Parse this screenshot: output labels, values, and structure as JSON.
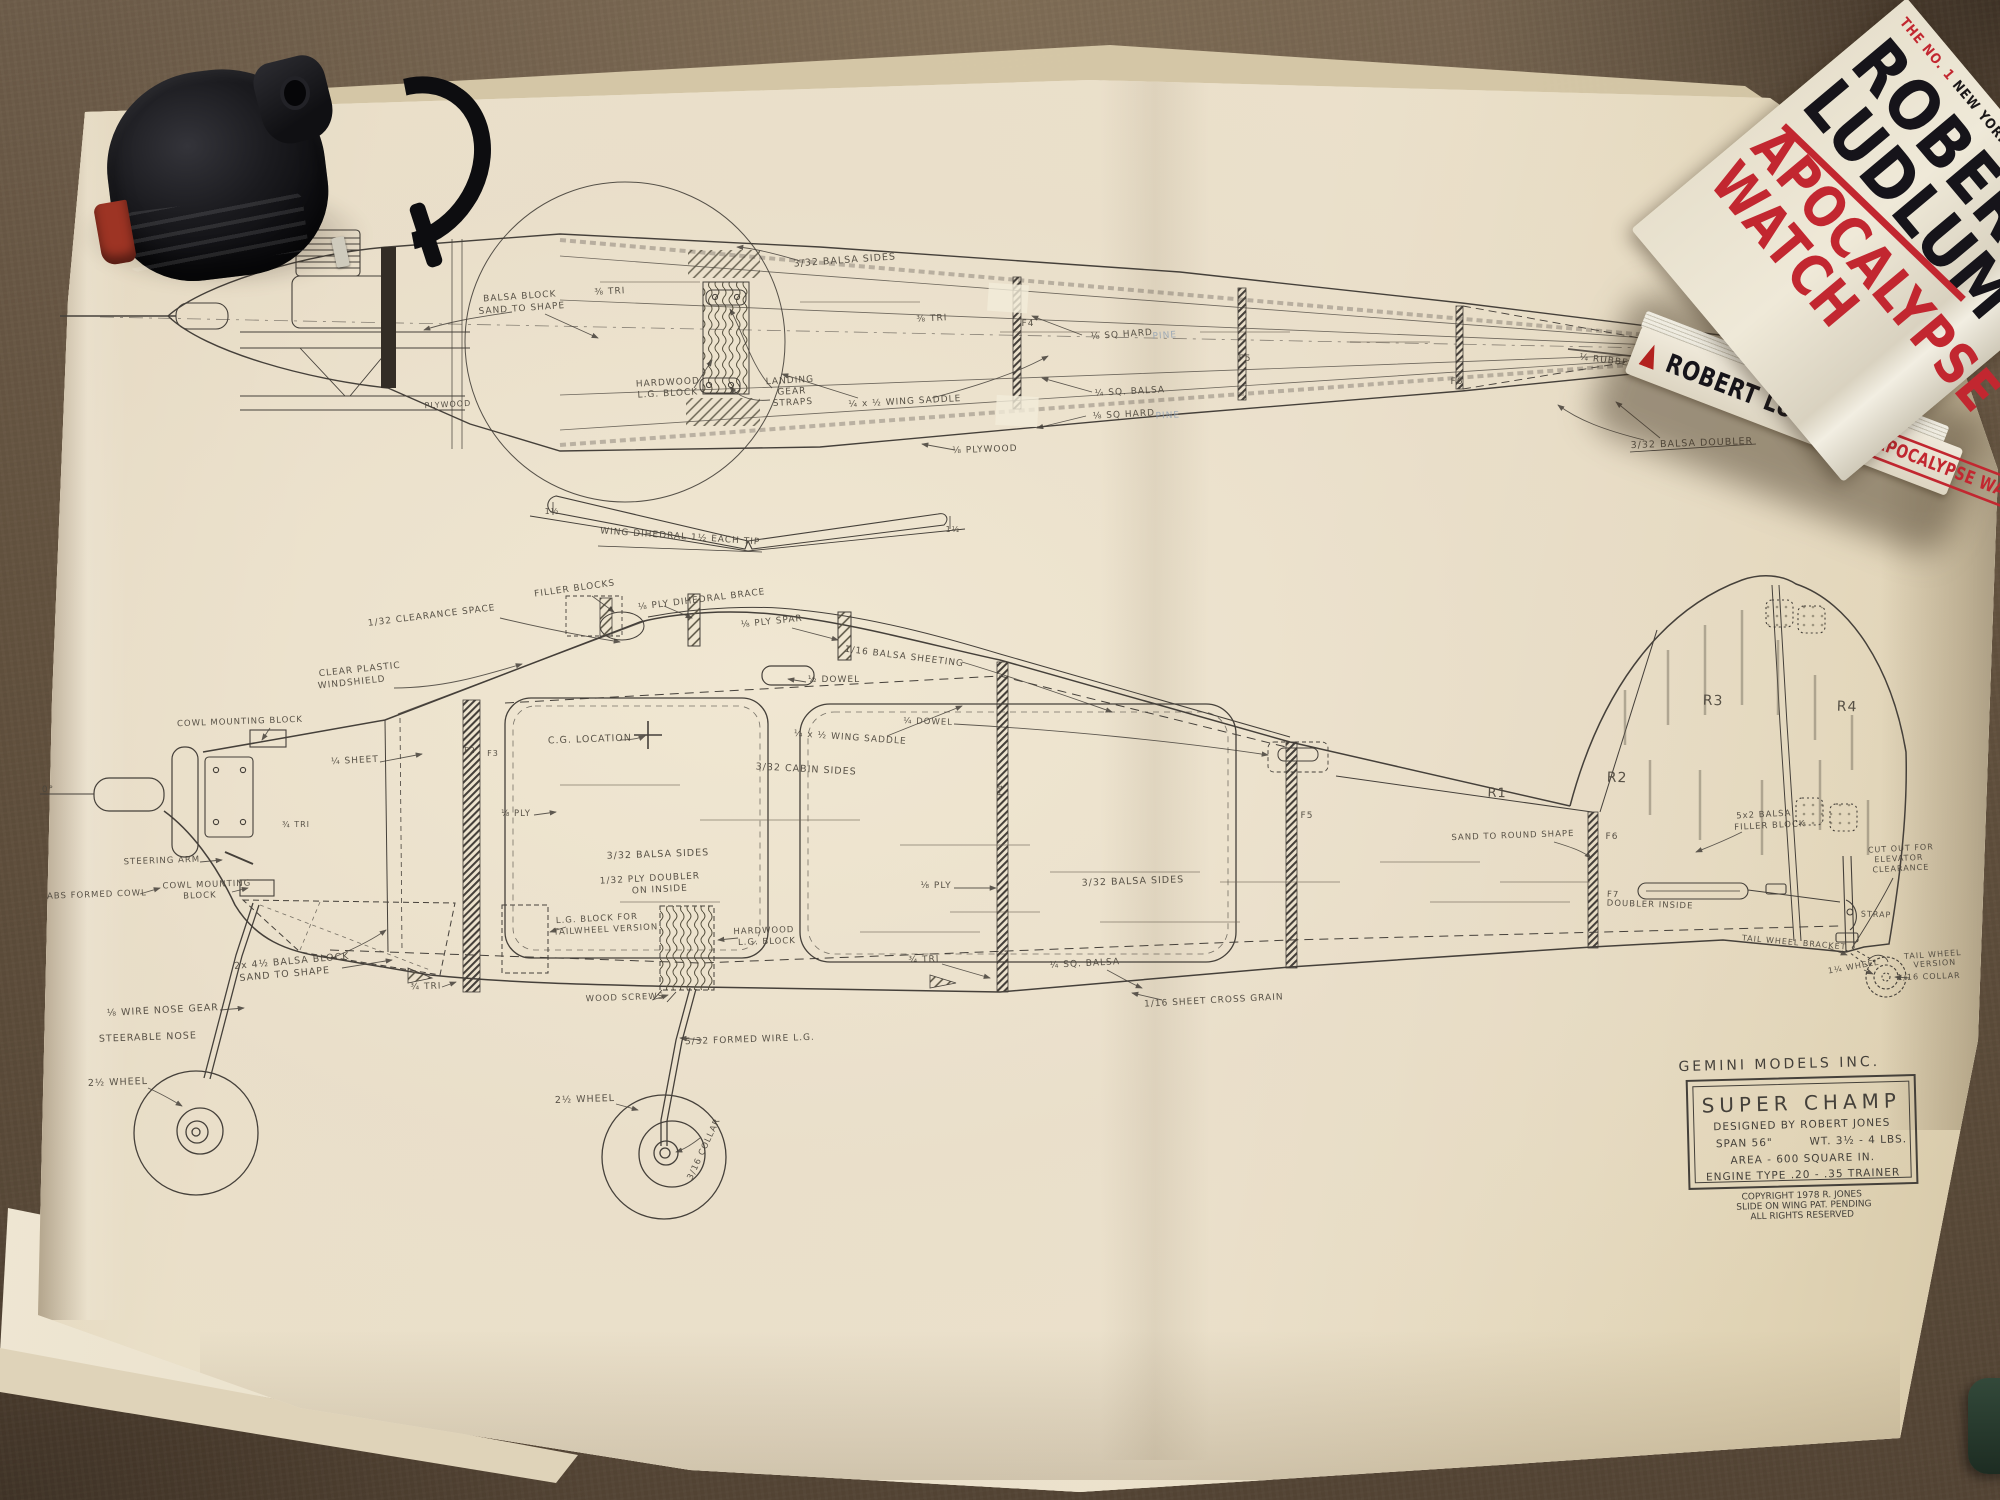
{
  "scene": {
    "carpet_color": "#63523f",
    "paper_color": "#e8ddc5",
    "ink_color": "#3f3a31"
  },
  "tape_measure": {
    "body_color": "#1b1b1f",
    "accent_color": "#9d3424"
  },
  "book": {
    "bestseller_prefix": "THE NO. 1",
    "bestseller_rest": " NEW YORK TIMES BESTSELLER",
    "author_line1": "ROBERT",
    "author_line2": "LUDLUM",
    "title_line1": "APOCALYPSE",
    "title_line2": "WATCH",
    "spine_author": "ROBERT LUDLUM",
    "spine_title": "APOCALYPSE WATCH",
    "title_color": "#c22730",
    "author_color": "#16141a",
    "cover_color": "#e9e2d0"
  },
  "title_block": {
    "company": "GEMINI MODELS INC.",
    "model": "SUPER CHAMP",
    "designer": "DESIGNED BY ROBERT JONES",
    "specs_span": "SPAN 56\"",
    "specs_weight": "WT. 3½ - 4 LBS.",
    "specs_area": "AREA - 600 SQUARE IN.",
    "specs_engine": "ENGINE TYPE .20 - .35 TRAINER",
    "copyright_line1": "COPYRIGHT 1978 R. JONES",
    "copyright_line2": "SLIDE ON WING PAT. PENDING",
    "copyright_line3": "ALL RIGHTS RESERVED"
  },
  "plan_labels": [
    {
      "t": "BALSA BLOCK",
      "x": 520,
      "y": 299,
      "s": 9,
      "r": -4
    },
    {
      "t": "SAND TO SHAPE",
      "x": 522,
      "y": 311,
      "s": 9,
      "r": -4
    },
    {
      "t": "⅜ TRI",
      "x": 610,
      "y": 294,
      "s": 9,
      "r": -3
    },
    {
      "t": "HARDWOOD",
      "x": 668,
      "y": 385,
      "s": 9,
      "r": -3
    },
    {
      "t": "L.G. BLOCK",
      "x": 668,
      "y": 396,
      "s": 9,
      "r": -3
    },
    {
      "t": "LANDING",
      "x": 790,
      "y": 383,
      "s": 9,
      "r": -3
    },
    {
      "t": "GEAR",
      "x": 792,
      "y": 394,
      "s": 9,
      "r": -3
    },
    {
      "t": "STRAPS",
      "x": 793,
      "y": 405,
      "s": 9,
      "r": -3
    },
    {
      "t": "¼ x ½ WING SADDLE",
      "x": 905,
      "y": 404,
      "s": 9,
      "r": -3
    },
    {
      "t": "3/32 BALSA SIDES",
      "x": 845,
      "y": 263,
      "s": 9.5,
      "r": -4
    },
    {
      "t": "⅜ TRI",
      "x": 932,
      "y": 321,
      "s": 9,
      "r": -3
    },
    {
      "t": "⅛ PLYWOOD",
      "x": 985,
      "y": 452,
      "s": 9,
      "r": -2
    },
    {
      "t": "PLYWOOD",
      "x": 448,
      "y": 407,
      "s": 8,
      "r": -3
    },
    {
      "t": "⅛ SQ HARD",
      "x": 1122,
      "y": 337,
      "s": 9,
      "r": -4
    },
    {
      "t": "PINE",
      "x": 1165,
      "y": 338,
      "s": 9,
      "r": -4,
      "c": "pencil"
    },
    {
      "t": "¼ SQ. BALSA",
      "x": 1130,
      "y": 394,
      "s": 9,
      "r": -3
    },
    {
      "t": "⅛ SQ HARD",
      "x": 1124,
      "y": 417,
      "s": 9,
      "r": -3
    },
    {
      "t": "PINE",
      "x": 1168,
      "y": 418,
      "s": 9,
      "r": -3,
      "c": "pencil"
    },
    {
      "t": "F4",
      "x": 1028,
      "y": 326,
      "s": 9,
      "r": 0
    },
    {
      "t": "F5",
      "x": 1245,
      "y": 361,
      "s": 9,
      "r": 0
    },
    {
      "t": "F6",
      "x": 1457,
      "y": 384,
      "s": 9,
      "r": 0
    },
    {
      "t": "¼ RUBBER CONTROL ROD",
      "x": 1648,
      "y": 368,
      "s": 9,
      "r": 7
    },
    {
      "t": "3/32 BALSA DOUBLER",
      "x": 1692,
      "y": 446,
      "s": 9.5,
      "r": -2
    },
    {
      "t": "1½",
      "x": 552,
      "y": 514,
      "s": 8,
      "r": 0
    },
    {
      "t": "WING DIHEDRAL 1½ EACH TIP",
      "x": 680,
      "y": 539,
      "s": 9,
      "r": 4
    },
    {
      "t": "1½",
      "x": 953,
      "y": 532,
      "s": 8,
      "r": 0
    },
    {
      "t": "FILLER BLOCKS",
      "x": 575,
      "y": 591,
      "s": 9,
      "r": -8
    },
    {
      "t": "⅛ PLY DIHEDRAL BRACE",
      "x": 702,
      "y": 602,
      "s": 9,
      "r": -7
    },
    {
      "t": "1/32 CLEARANCE SPACE",
      "x": 432,
      "y": 618,
      "s": 9,
      "r": -7
    },
    {
      "t": "⅛ PLY SPAR",
      "x": 772,
      "y": 624,
      "s": 9,
      "r": -6
    },
    {
      "t": "1/16 BALSA SHEETING",
      "x": 904,
      "y": 659,
      "s": 9,
      "r": 7
    },
    {
      "t": "CLEAR PLASTIC",
      "x": 360,
      "y": 672,
      "s": 9,
      "r": -6
    },
    {
      "t": "WINDSHIELD",
      "x": 352,
      "y": 685,
      "s": 9,
      "r": -6
    },
    {
      "t": "½ DOWEL",
      "x": 834,
      "y": 682,
      "s": 9,
      "r": 0
    },
    {
      "t": "COWL MOUNTING BLOCK",
      "x": 240,
      "y": 724,
      "s": 8.5,
      "r": -2
    },
    {
      "t": "¼ DOWEL",
      "x": 928,
      "y": 724,
      "s": 8.5,
      "r": 2
    },
    {
      "t": "C.G. LOCATION",
      "x": 590,
      "y": 742,
      "s": 9.5,
      "r": -2
    },
    {
      "t": "¼ x ½ WING SADDLE",
      "x": 850,
      "y": 740,
      "s": 9,
      "r": 4
    },
    {
      "t": "F2",
      "x": 470,
      "y": 753,
      "s": 8,
      "r": 0
    },
    {
      "t": "F3",
      "x": 493,
      "y": 756,
      "s": 8,
      "r": 0
    },
    {
      "t": "¼ SHEET",
      "x": 355,
      "y": 763,
      "s": 9,
      "r": -3
    },
    {
      "t": "3/32 CABIN SIDES",
      "x": 806,
      "y": 772,
      "s": 9.5,
      "r": 3
    },
    {
      "t": "R1",
      "x": 1497,
      "y": 797,
      "s": 13,
      "r": 2
    },
    {
      "t": "R2",
      "x": 1617,
      "y": 782,
      "s": 14,
      "r": 2
    },
    {
      "t": "R3",
      "x": 1713,
      "y": 705,
      "s": 14,
      "r": 2
    },
    {
      "t": "R4",
      "x": 1847,
      "y": 711,
      "s": 14,
      "r": 2
    },
    {
      "t": "F4",
      "x": 1003,
      "y": 790,
      "s": 8,
      "r": -90
    },
    {
      "t": "F5",
      "x": 1307,
      "y": 818,
      "s": 9,
      "r": 0
    },
    {
      "t": "⅛ PLY",
      "x": 516,
      "y": 816,
      "s": 8.5,
      "r": 0
    },
    {
      "t": "¾ TRI",
      "x": 296,
      "y": 827,
      "s": 8,
      "r": 0
    },
    {
      "t": "SAND TO ROUND SHAPE",
      "x": 1513,
      "y": 838,
      "s": 8.5,
      "r": -2
    },
    {
      "t": "F6",
      "x": 1612,
      "y": 839,
      "s": 9,
      "r": 0
    },
    {
      "t": "5x2 BALSA",
      "x": 1764,
      "y": 817,
      "s": 8.5,
      "r": -3
    },
    {
      "t": "FILLER BLOCK",
      "x": 1770,
      "y": 828,
      "s": 8.5,
      "r": -3
    },
    {
      "t": "3/32 BALSA SIDES",
      "x": 658,
      "y": 857,
      "s": 9.5,
      "r": -2
    },
    {
      "t": "CUT OUT FOR",
      "x": 1901,
      "y": 851,
      "s": 8,
      "r": -3
    },
    {
      "t": "ELEVATOR",
      "x": 1899,
      "y": 861,
      "s": 8,
      "r": -3
    },
    {
      "t": "CLEARANCE",
      "x": 1901,
      "y": 871,
      "s": 8,
      "r": -3
    },
    {
      "t": "STEERING ARM",
      "x": 162,
      "y": 863,
      "s": 8.5,
      "r": -2
    },
    {
      "t": "1/32 PLY DOUBLER",
      "x": 650,
      "y": 881,
      "s": 9,
      "r": -3
    },
    {
      "t": "ON INSIDE",
      "x": 660,
      "y": 892,
      "s": 9,
      "r": -3
    },
    {
      "t": "3/32 BALSA SIDES",
      "x": 1133,
      "y": 884,
      "s": 9.5,
      "r": -2
    },
    {
      "t": "⅛ PLY",
      "x": 936,
      "y": 888,
      "s": 9,
      "r": 0
    },
    {
      "t": "COWL MOUNTING",
      "x": 207,
      "y": 887,
      "s": 8.5,
      "r": -2
    },
    {
      "t": "BLOCK",
      "x": 200,
      "y": 898,
      "s": 8.5,
      "r": -2
    },
    {
      "t": "ABS FORMED COWL",
      "x": 97,
      "y": 897,
      "s": 8.5,
      "r": -2
    },
    {
      "t": "F7",
      "x": 1613,
      "y": 897,
      "s": 8.5,
      "r": 2
    },
    {
      "t": "DOUBLER INSIDE",
      "x": 1650,
      "y": 907,
      "s": 8.5,
      "r": 2
    },
    {
      "t": "STRAP",
      "x": 1876,
      "y": 917,
      "s": 8,
      "r": 2
    },
    {
      "t": "L.G. BLOCK FOR",
      "x": 597,
      "y": 921,
      "s": 8.5,
      "r": -3
    },
    {
      "t": "TAILWHEEL VERSION",
      "x": 606,
      "y": 932,
      "s": 8.5,
      "r": -3
    },
    {
      "t": "HARDWOOD",
      "x": 764,
      "y": 933,
      "s": 8.5,
      "r": -2
    },
    {
      "t": "L.G. BLOCK",
      "x": 767,
      "y": 944,
      "s": 8.5,
      "r": -2
    },
    {
      "t": "TAIL WHEEL BRACKET",
      "x": 1794,
      "y": 945,
      "s": 8,
      "r": 5
    },
    {
      "t": "TAIL WHEEL",
      "x": 1933,
      "y": 957,
      "s": 8,
      "r": -4
    },
    {
      "t": "VERSION",
      "x": 1935,
      "y": 966,
      "s": 8,
      "r": -4
    },
    {
      "t": "2x 4½ BALSA BLOCK",
      "x": 292,
      "y": 964,
      "s": 9.5,
      "r": -5
    },
    {
      "t": "SAND TO SHAPE",
      "x": 285,
      "y": 977,
      "s": 9.5,
      "r": -5
    },
    {
      "t": "¾ TRI",
      "x": 924,
      "y": 962,
      "s": 9,
      "r": -2
    },
    {
      "t": "¼ SQ. BALSA",
      "x": 1085,
      "y": 966,
      "s": 9,
      "r": -3
    },
    {
      "t": "1¼ WHEEL",
      "x": 1854,
      "y": 969,
      "s": 8,
      "r": -10
    },
    {
      "t": "1/16 COLLAR",
      "x": 1929,
      "y": 979,
      "s": 8,
      "r": -2
    },
    {
      "t": "¾ TRI",
      "x": 426,
      "y": 989,
      "s": 9,
      "r": -2
    },
    {
      "t": "WOOD SCREWS",
      "x": 625,
      "y": 1000,
      "s": 8.5,
      "r": -2
    },
    {
      "t": "1/16 SHEET CROSS GRAIN",
      "x": 1214,
      "y": 1003,
      "s": 9,
      "r": -3
    },
    {
      "t": "⅛ WIRE NOSE GEAR",
      "x": 163,
      "y": 1013,
      "s": 9.5,
      "r": -3
    },
    {
      "t": "STEERABLE NOSE",
      "x": 148,
      "y": 1040,
      "s": 9.5,
      "r": -2
    },
    {
      "t": "5/32 FORMED WIRE L.G.",
      "x": 750,
      "y": 1042,
      "s": 9,
      "r": -2
    },
    {
      "t": "2½ WHEEL",
      "x": 118,
      "y": 1085,
      "s": 9.5,
      "r": -2
    },
    {
      "t": "2½ WHEEL",
      "x": 585,
      "y": 1102,
      "s": 9.5,
      "r": -2
    },
    {
      "t": "3/16 COLLAR",
      "x": 706,
      "y": 1150,
      "s": 8.5,
      "r": -65
    },
    {
      "t": "0°",
      "x": 48,
      "y": 792,
      "s": 9,
      "r": 0
    }
  ]
}
